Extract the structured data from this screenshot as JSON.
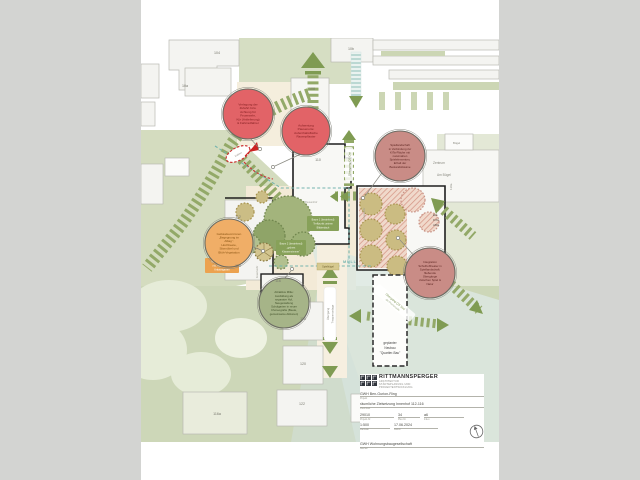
{
  "colors": {
    "margin": "#d3d4d2",
    "sheet": "#ffffff",
    "sage": "#ccd6b4",
    "cream": "#f3ead7",
    "mint": "#dce8e1",
    "band_green": "#93a968",
    "arrow_green": "#7f9b52",
    "bubble_red": "#e26367",
    "bubble_rose": "#c98c86",
    "bubble_orange": "#f0ae67",
    "bubble_sage": "#a6b488",
    "teal_dashed": "#74b4ae",
    "red_dashed": "#cc3333",
    "kita_hatch": "#d49181"
  },
  "building_labels": [
    "104",
    "10a",
    "108",
    "110",
    "10b",
    "112",
    "114",
    "116",
    "118",
    "120",
    "122",
    "116a"
  ],
  "area_labels": {
    "zentrum": "Zentrum",
    "am_buegel": "Am Bügel",
    "buegel": "Bügel",
    "b110a": "110a",
    "eg1": "EG:",
    "eg2": "KiTa",
    "eg3": "ABG"
  },
  "micro_labels": {
    "muell": "MÜLL",
    "zufahrt": "Zufahrt",
    "feuerwehr": "Feuerwehr",
    "pausenhof": "Pausenhof"
  },
  "band_labels": {
    "qs_ost": "Übergang QS Ost",
    "treppe1": "Übergang",
    "treppe2": "Treppenanlage",
    "qs_sued1": "Übergang QS Süd",
    "qs_sued2": "als Promenade"
  },
  "neubau": {
    "l1": "geplanter",
    "l2": "Neubau",
    "l3": "\"Quartier-Bau\""
  },
  "bubbles": [
    {
      "topic": "zufahrt-verlegung",
      "lines": [
        "Verlegung der",
        "Zufahrt bzw.",
        "Achtung für",
        "Feuerwehr,",
        "Kfz (Anlieferung)",
        "& Fahrradfahrer"
      ]
    },
    {
      "topic": "pausenorte",
      "lines": [
        "Aufwertung",
        "Pausenorte:",
        "Aufenthaltsfläche",
        "Rasenpflaster"
      ]
    },
    {
      "topic": "spiellandschaft-kita",
      "lines": [
        "Spiellandschaft",
        "in Verbindung zur",
        "KiTa-Fläche mit",
        "naturnahen",
        "Spielelementen,",
        "Erhalt der",
        "Bestandsbäume"
      ]
    },
    {
      "topic": "schulhoftheater",
      "lines": [
        "Integration",
        "Schulhoftheater in",
        "Spiellandschaft:",
        "fließende",
        "Übergänge",
        "zwischen Spiel &",
        "Natur"
      ]
    },
    {
      "topic": "gebaeudevorzonen",
      "lines": [
        "Gebäudevorzonen",
        "„Begegnung im",
        "Alltag“:",
        "Hochbeete,",
        "Sitzmöbel und",
        "Blüh-Vegetation"
      ]
    },
    {
      "topic": "attraktive-mitte",
      "lines": [
        "Attraktive Mitte:",
        "Ausbildung als",
        "separater Hof,",
        "Neugestaltung",
        "Schulgarten in neuer",
        "Choreografie (Beete,",
        "gemeinsame Aktionen)"
      ]
    }
  ],
  "note_boxes": {
    "baum1": [
      "Baum 1 (bestehend)",
      "Treffpunkt unterm",
      "Blätterdach"
    ],
    "baum2": [
      "Baum 2 (bestehend)",
      "„grünes",
      "Klassenzimmer“"
    ],
    "huegel": "Spielhügel",
    "aktionen": [
      "Raum für Aktionen:",
      "z.B. Boulebahn &",
      "Kräutergarten"
    ]
  },
  "titleblock": {
    "firm": "RITTMANNSPERGER",
    "firm_sub1": "ARCHITEKTUR",
    "firm_sub2": "STÄDTEPLANUNG UND",
    "firm_sub3": "PROJEKTENTWICKLUNG",
    "project": {
      "value": "GWH Ben-Gurion-Ring",
      "label": "Projekt"
    },
    "plan": {
      "value": "räumliche Zielsetzung Innenhof 112-116",
      "label": "Planinhalt"
    },
    "nr1": {
      "value": "29010",
      "label": "Projekt-Nr."
    },
    "nr2": {
      "value": "34",
      "label": "Plan-Nr."
    },
    "nr3": {
      "value": "a6",
      "label": "Index"
    },
    "scale": {
      "value": "1:500",
      "label": "Maßstab"
    },
    "date": {
      "value": "17.06.2024",
      "label": "Datum"
    },
    "client": {
      "value": "GWH Wohnungsbaugesellschaft",
      "label": "Bauherr"
    }
  }
}
